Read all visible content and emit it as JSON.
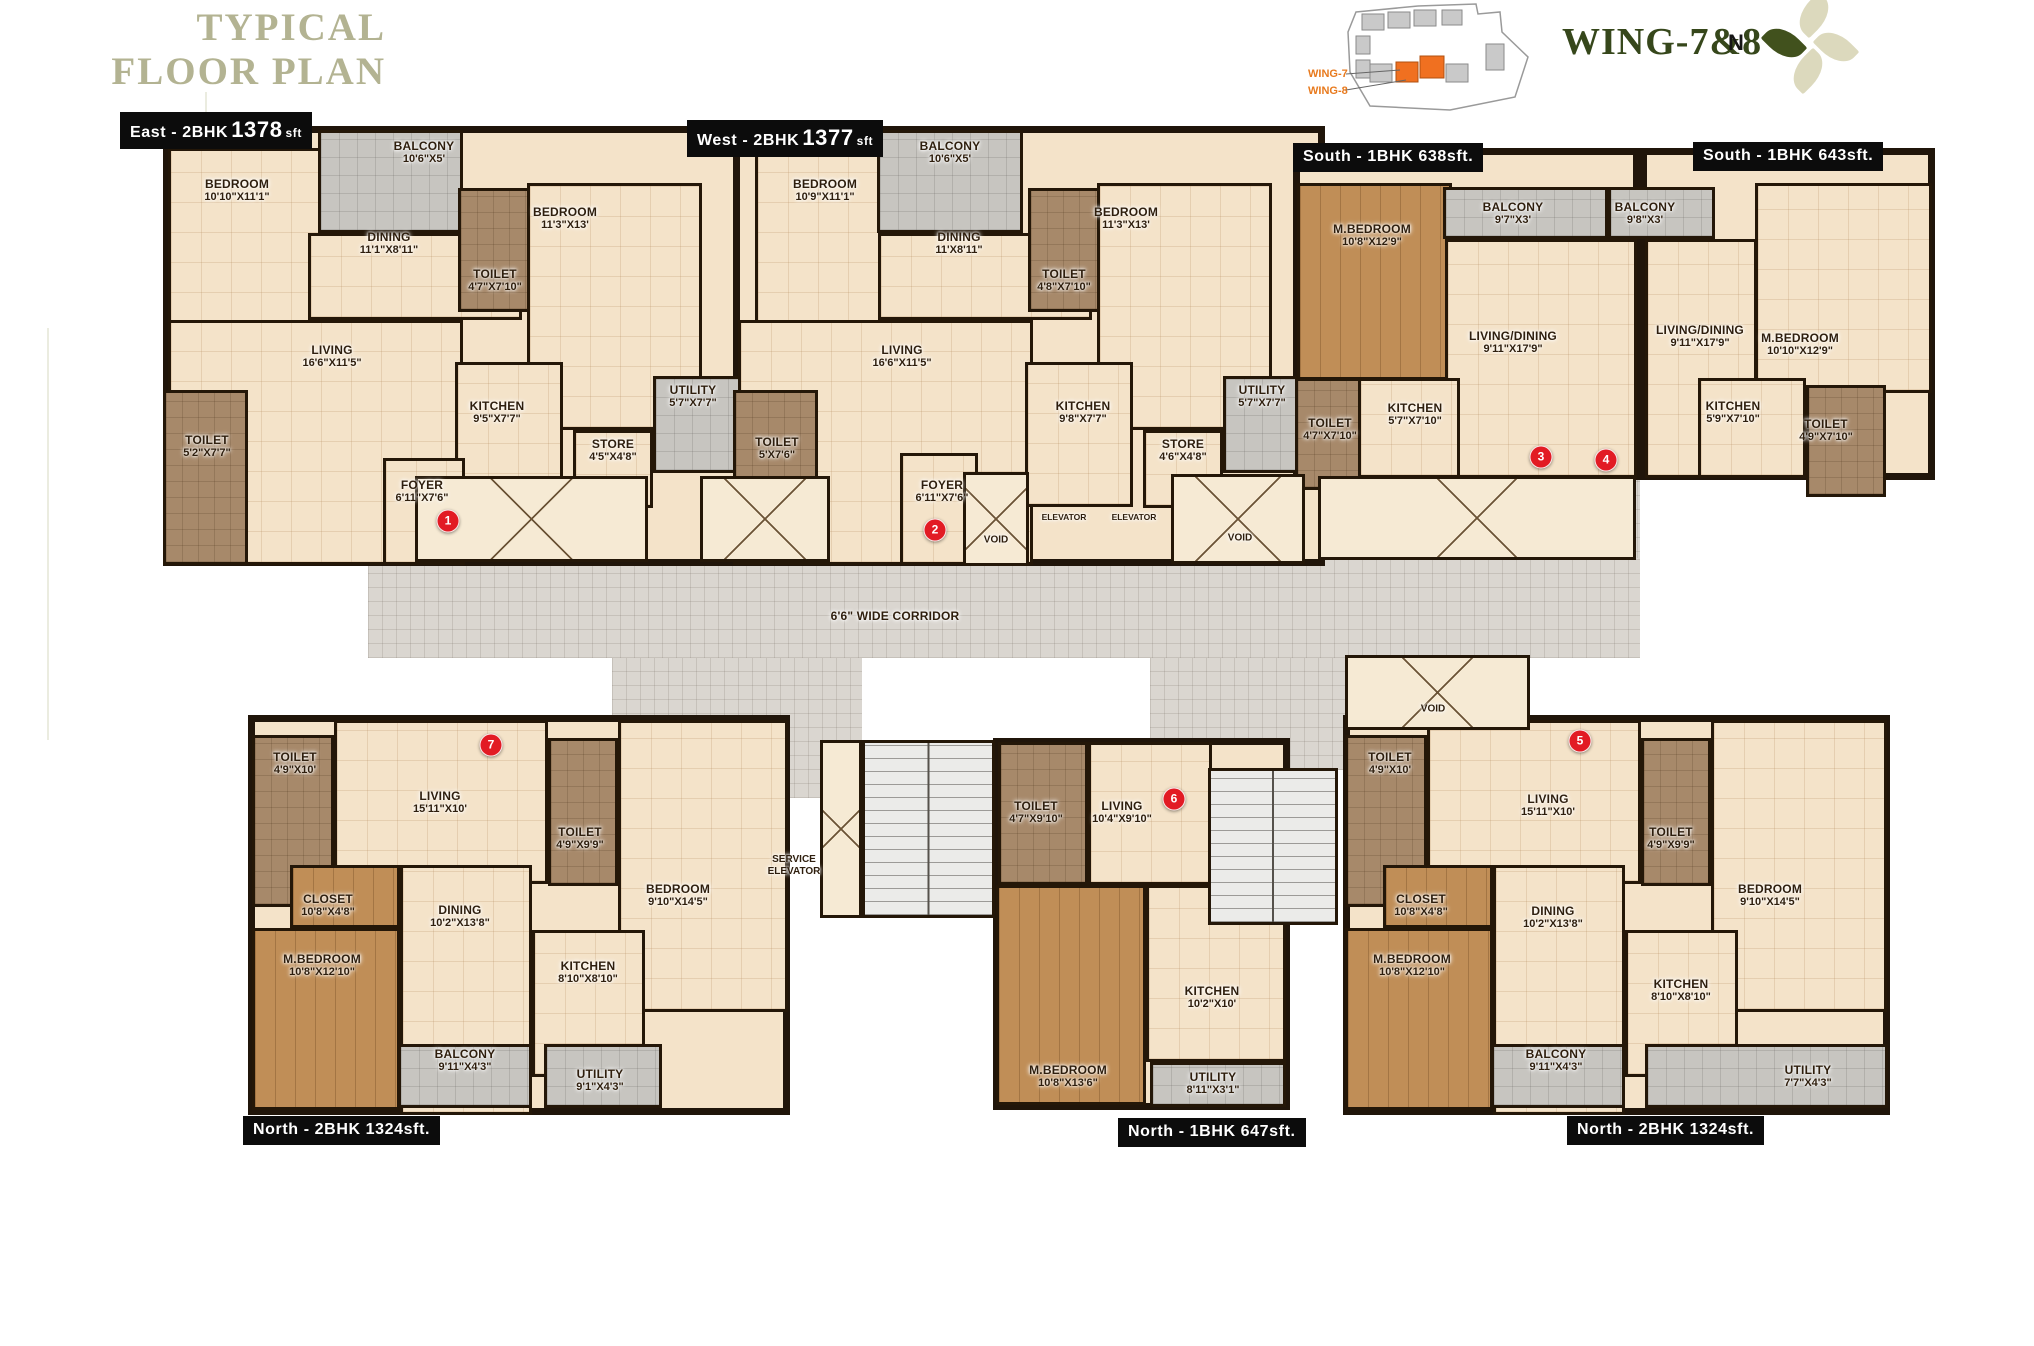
{
  "header": {
    "title_line1": "TYPICAL",
    "title_line2": "FLOOR PLAN",
    "wing_title": "WING-7&8",
    "north_label": "N",
    "keyplan": {
      "wing7": "WING-7",
      "wing8": "WING-8",
      "highlight_color": "#f07020",
      "building_color": "#c9c9c9"
    }
  },
  "colors": {
    "wall": "#241708",
    "cream": "#f4e3c9",
    "toilet": "#a7896a",
    "wood": "#c08e57",
    "gray": "#c7c5c0",
    "corridor": "#dad6d0",
    "badge_red": "#e21b24",
    "title_sage": "#b3b392",
    "wing_green": "#36471b",
    "accent_orange": "#e87a1e"
  },
  "plates": [
    {
      "id": "east",
      "x": 120,
      "y": 112,
      "pre": "East - 2BHK",
      "big": "1378",
      "suf": "sft"
    },
    {
      "id": "west",
      "x": 687,
      "y": 120,
      "pre": "West - 2BHK",
      "big": "1377",
      "suf": "sft"
    },
    {
      "id": "s638",
      "x": 1293,
      "y": 143,
      "pre": "South - 1BHK 638sft.",
      "big": "",
      "suf": ""
    },
    {
      "id": "s643",
      "x": 1693,
      "y": 142,
      "pre": "South - 1BHK 643sft.",
      "big": "",
      "suf": ""
    },
    {
      "id": "n1324a",
      "x": 243,
      "y": 1116,
      "pre": "North - 2BHK 1324sft.",
      "big": "",
      "suf": ""
    },
    {
      "id": "n647",
      "x": 1118,
      "y": 1118,
      "pre": "North - 1BHK 647sft.",
      "big": "",
      "suf": ""
    },
    {
      "id": "n1324b",
      "x": 1567,
      "y": 1116,
      "pre": "North - 2BHK 1324sft.",
      "big": "",
      "suf": ""
    }
  ],
  "corridor_areas": [
    {
      "id": "corridor-upper",
      "rect": [
        755,
        470,
        885,
        96
      ]
    },
    {
      "id": "corridor-main",
      "rect": [
        368,
        558,
        1272,
        100
      ],
      "label": "6'6\" WIDE CORRIDOR",
      "lx": 895,
      "ly": 616
    },
    {
      "id": "lobby-left",
      "rect": [
        612,
        658,
        250,
        140
      ]
    },
    {
      "id": "lobby-right",
      "rect": [
        1150,
        658,
        198,
        112
      ]
    }
  ],
  "units": [
    {
      "id": "east",
      "rect": [
        163,
        126,
        595,
        440
      ]
    },
    {
      "id": "west",
      "rect": [
        733,
        126,
        592,
        440
      ]
    },
    {
      "id": "s638",
      "rect": [
        1293,
        148,
        347,
        332
      ]
    },
    {
      "id": "s643",
      "rect": [
        1640,
        148,
        295,
        332
      ]
    },
    {
      "id": "n7",
      "rect": [
        248,
        715,
        542,
        400
      ]
    },
    {
      "id": "n6",
      "rect": [
        993,
        738,
        297,
        372
      ]
    },
    {
      "id": "n5",
      "rect": [
        1343,
        715,
        547,
        400
      ]
    }
  ],
  "rooms": [
    {
      "unit": "east",
      "name": "BEDROOM",
      "dims": "10'10\"X11'1\"",
      "type": "cream",
      "rect": [
        168,
        148,
        237,
        268
      ],
      "lx": 237,
      "ly": 190
    },
    {
      "unit": "east",
      "name": "BALCONY",
      "dims": "10'6\"X5'",
      "type": "gray",
      "rect": [
        318,
        130,
        145,
        103
      ],
      "lx": 424,
      "ly": 152
    },
    {
      "unit": "east",
      "name": "DINING",
      "dims": "11'1\"X8'11\"",
      "type": "cream",
      "rect": [
        308,
        233,
        214,
        87
      ],
      "lx": 389,
      "ly": 243
    },
    {
      "unit": "east",
      "name": "LIVING",
      "dims": "16'6\"X11'5\"",
      "type": "cream",
      "rect": [
        168,
        320,
        295,
        245
      ],
      "lx": 332,
      "ly": 356
    },
    {
      "unit": "east",
      "name": "TOILET",
      "dims": "4'7\"X7'10\"",
      "type": "toilet",
      "rect": [
        458,
        188,
        72,
        124
      ],
      "lx": 495,
      "ly": 280
    },
    {
      "unit": "east",
      "name": "BEDROOM",
      "dims": "11'3\"X13'",
      "type": "cream",
      "rect": [
        527,
        183,
        175,
        247
      ],
      "lx": 565,
      "ly": 218
    },
    {
      "unit": "east",
      "name": "TOILET",
      "dims": "5'2\"X7'7\"",
      "type": "toilet",
      "rect": [
        163,
        390,
        85,
        175
      ],
      "lx": 207,
      "ly": 446
    },
    {
      "unit": "east",
      "name": "KITCHEN",
      "dims": "9'5\"X7'7\"",
      "type": "cream",
      "rect": [
        455,
        362,
        108,
        145
      ],
      "lx": 497,
      "ly": 412
    },
    {
      "unit": "east",
      "name": "STORE",
      "dims": "4'5\"X4'8\"",
      "type": "cream",
      "rect": [
        573,
        430,
        80,
        78
      ],
      "lx": 613,
      "ly": 450
    },
    {
      "unit": "east",
      "name": "UTILITY",
      "dims": "5'7\"X7'7\"",
      "type": "gray",
      "rect": [
        653,
        376,
        102,
        97
      ],
      "lx": 693,
      "ly": 396
    },
    {
      "unit": "east",
      "name": "FOYER",
      "dims": "6'11\"X7'6\"",
      "type": "cream",
      "rect": [
        383,
        458,
        82,
        107
      ],
      "lx": 422,
      "ly": 491
    },
    {
      "unit": "west",
      "name": "BEDROOM",
      "dims": "10'9\"X11'1\"",
      "type": "cream",
      "rect": [
        755,
        148,
        237,
        268
      ],
      "lx": 825,
      "ly": 190
    },
    {
      "unit": "west",
      "name": "BALCONY",
      "dims": "10'6\"X5'",
      "type": "gray",
      "rect": [
        877,
        130,
        146,
        103
      ],
      "lx": 950,
      "ly": 152
    },
    {
      "unit": "west",
      "name": "DINING",
      "dims": "11'X8'11\"",
      "type": "cream",
      "rect": [
        878,
        233,
        214,
        87
      ],
      "lx": 959,
      "ly": 243
    },
    {
      "unit": "west",
      "name": "LIVING",
      "dims": "16'6\"X11'5\"",
      "type": "cream",
      "rect": [
        738,
        320,
        295,
        245
      ],
      "lx": 902,
      "ly": 356
    },
    {
      "unit": "west",
      "name": "TOILET",
      "dims": "4'8\"X7'10\"",
      "type": "toilet",
      "rect": [
        1028,
        188,
        72,
        124
      ],
      "lx": 1064,
      "ly": 280
    },
    {
      "unit": "west",
      "name": "BEDROOM",
      "dims": "11'3\"X13'",
      "type": "cream",
      "rect": [
        1097,
        183,
        175,
        247
      ],
      "lx": 1126,
      "ly": 218
    },
    {
      "unit": "west",
      "name": "TOILET",
      "dims": "5'X7'6\"",
      "type": "toilet",
      "rect": [
        733,
        390,
        85,
        175
      ],
      "lx": 777,
      "ly": 448
    },
    {
      "unit": "west",
      "name": "KITCHEN",
      "dims": "9'8\"X7'7\"",
      "type": "cream",
      "rect": [
        1025,
        362,
        108,
        145
      ],
      "lx": 1083,
      "ly": 412
    },
    {
      "unit": "west",
      "name": "STORE",
      "dims": "4'6\"X4'8\"",
      "type": "cream",
      "rect": [
        1143,
        430,
        80,
        78
      ],
      "lx": 1183,
      "ly": 450
    },
    {
      "unit": "west",
      "name": "UTILITY",
      "dims": "5'7\"X7'7\"",
      "type": "gray",
      "rect": [
        1223,
        376,
        100,
        97
      ],
      "lx": 1262,
      "ly": 396
    },
    {
      "unit": "west",
      "name": "FOYER",
      "dims": "6'11\"X7'6\"",
      "type": "cream",
      "rect": [
        900,
        453,
        78,
        112
      ],
      "lx": 942,
      "ly": 491
    },
    {
      "unit": "s638",
      "name": "M.BEDROOM",
      "dims": "10'8\"X12'9\"",
      "type": "wood",
      "rect": [
        1297,
        183,
        155,
        197
      ],
      "lx": 1372,
      "ly": 235
    },
    {
      "unit": "s638",
      "name": "BALCONY",
      "dims": "9'7\"X3'",
      "type": "gray",
      "rect": [
        1443,
        187,
        165,
        52
      ],
      "lx": 1513,
      "ly": 213
    },
    {
      "unit": "s638",
      "name": "LIVING/DINING",
      "dims": "9'11\"X17'9\"",
      "type": "cream",
      "rect": [
        1445,
        239,
        192,
        239
      ],
      "lx": 1513,
      "ly": 342
    },
    {
      "unit": "s638",
      "name": "KITCHEN",
      "dims": "5'7\"X7'10\"",
      "type": "cream",
      "rect": [
        1358,
        378,
        102,
        100
      ],
      "lx": 1415,
      "ly": 414
    },
    {
      "unit": "s638",
      "name": "TOILET",
      "dims": "4'7\"X7'10\"",
      "type": "toilet",
      "rect": [
        1295,
        378,
        66,
        112
      ],
      "lx": 1330,
      "ly": 429
    },
    {
      "unit": "s643",
      "name": "BALCONY",
      "dims": "9'8\"X3'",
      "type": "gray",
      "rect": [
        1608,
        187,
        107,
        52
      ],
      "lx": 1645,
      "ly": 213
    },
    {
      "unit": "s643",
      "name": "LIVING/DINING",
      "dims": "9'11\"X17'9\"",
      "type": "cream",
      "rect": [
        1645,
        239,
        112,
        239
      ],
      "lx": 1700,
      "ly": 336
    },
    {
      "unit": "s643",
      "name": "M.BEDROOM",
      "dims": "10'10\"X12'9\"",
      "type": "cream",
      "rect": [
        1755,
        183,
        177,
        210
      ],
      "lx": 1800,
      "ly": 344
    },
    {
      "unit": "s643",
      "name": "KITCHEN",
      "dims": "5'9\"X7'10\"",
      "type": "cream",
      "rect": [
        1698,
        378,
        108,
        100
      ],
      "lx": 1733,
      "ly": 412
    },
    {
      "unit": "s643",
      "name": "TOILET",
      "dims": "4'9\"X7'10\"",
      "type": "toilet",
      "rect": [
        1806,
        385,
        80,
        112
      ],
      "lx": 1826,
      "ly": 430
    },
    {
      "unit": "n7",
      "name": "TOILET",
      "dims": "4'9\"X10'",
      "type": "toilet",
      "rect": [
        252,
        735,
        82,
        172
      ],
      "lx": 295,
      "ly": 763
    },
    {
      "unit": "n7",
      "name": "LIVING",
      "dims": "15'11\"X10'",
      "type": "cream",
      "rect": [
        334,
        720,
        214,
        164
      ],
      "lx": 440,
      "ly": 802
    },
    {
      "unit": "n7",
      "name": "TOILET",
      "dims": "4'9\"X9'9\"",
      "type": "toilet",
      "rect": [
        548,
        738,
        70,
        148
      ],
      "lx": 580,
      "ly": 838
    },
    {
      "unit": "n7",
      "name": "BEDROOM",
      "dims": "9'10\"X14'5\"",
      "type": "cream",
      "rect": [
        618,
        720,
        170,
        292
      ],
      "lx": 678,
      "ly": 895
    },
    {
      "unit": "n7",
      "name": "CLOSET",
      "dims": "10'8\"X4'8\"",
      "type": "wood",
      "rect": [
        290,
        865,
        110,
        63
      ],
      "lx": 328,
      "ly": 905
    },
    {
      "unit": "n7",
      "name": "M.BEDROOM",
      "dims": "10'8\"X12'10\"",
      "type": "wood",
      "rect": [
        252,
        928,
        148,
        182
      ],
      "lx": 322,
      "ly": 965
    },
    {
      "unit": "n7",
      "name": "DINING",
      "dims": "10'2\"X13'8\"",
      "type": "cream",
      "rect": [
        400,
        865,
        132,
        250
      ],
      "lx": 460,
      "ly": 916
    },
    {
      "unit": "n7",
      "name": "KITCHEN",
      "dims": "8'10\"X8'10\"",
      "type": "cream",
      "rect": [
        532,
        930,
        113,
        147
      ],
      "lx": 588,
      "ly": 972
    },
    {
      "unit": "n7",
      "name": "BALCONY",
      "dims": "9'11\"X4'3\"",
      "type": "gray",
      "rect": [
        398,
        1044,
        134,
        64
      ],
      "lx": 465,
      "ly": 1060
    },
    {
      "unit": "n7",
      "name": "UTILITY",
      "dims": "9'1\"X4'3\"",
      "type": "gray",
      "rect": [
        544,
        1044,
        118,
        64
      ],
      "lx": 600,
      "ly": 1080
    },
    {
      "unit": "n6",
      "name": "TOILET",
      "dims": "4'7\"X9'10\"",
      "type": "toilet",
      "rect": [
        998,
        742,
        90,
        143
      ],
      "lx": 1036,
      "ly": 812
    },
    {
      "unit": "n6",
      "name": "LIVING",
      "dims": "10'4\"X9'10\"",
      "type": "cream",
      "rect": [
        1088,
        742,
        124,
        143
      ],
      "lx": 1122,
      "ly": 812
    },
    {
      "unit": "n6",
      "name": "M.BEDROOM",
      "dims": "10'8\"X13'6\"",
      "type": "wood",
      "rect": [
        996,
        885,
        150,
        220
      ],
      "lx": 1068,
      "ly": 1076
    },
    {
      "unit": "n6",
      "name": "KITCHEN",
      "dims": "10'2\"X10'",
      "type": "cream",
      "rect": [
        1146,
        885,
        140,
        177
      ],
      "lx": 1212,
      "ly": 997
    },
    {
      "unit": "n6",
      "name": "UTILITY",
      "dims": "8'11\"X3'1\"",
      "type": "gray",
      "rect": [
        1150,
        1062,
        136,
        45
      ],
      "lx": 1213,
      "ly": 1083
    },
    {
      "unit": "n5",
      "name": "TOILET",
      "dims": "4'9\"X10'",
      "type": "toilet",
      "rect": [
        1345,
        735,
        82,
        172
      ],
      "lx": 1390,
      "ly": 763
    },
    {
      "unit": "n5",
      "name": "LIVING",
      "dims": "15'11\"X10'",
      "type": "cream",
      "rect": [
        1427,
        720,
        214,
        164
      ],
      "lx": 1548,
      "ly": 805
    },
    {
      "unit": "n5",
      "name": "TOILET",
      "dims": "4'9\"X9'9\"",
      "type": "toilet",
      "rect": [
        1641,
        738,
        70,
        148
      ],
      "lx": 1671,
      "ly": 838
    },
    {
      "unit": "n5",
      "name": "BEDROOM",
      "dims": "9'10\"X14'5\"",
      "type": "cream",
      "rect": [
        1711,
        720,
        176,
        292
      ],
      "lx": 1770,
      "ly": 895
    },
    {
      "unit": "n5",
      "name": "CLOSET",
      "dims": "10'8\"X4'8\"",
      "type": "wood",
      "rect": [
        1383,
        865,
        110,
        63
      ],
      "lx": 1421,
      "ly": 905
    },
    {
      "unit": "n5",
      "name": "M.BEDROOM",
      "dims": "10'8\"X12'10\"",
      "type": "wood",
      "rect": [
        1345,
        928,
        148,
        182
      ],
      "lx": 1412,
      "ly": 965
    },
    {
      "unit": "n5",
      "name": "DINING",
      "dims": "10'2\"X13'8\"",
      "type": "cream",
      "rect": [
        1493,
        865,
        132,
        250
      ],
      "lx": 1553,
      "ly": 917
    },
    {
      "unit": "n5",
      "name": "KITCHEN",
      "dims": "8'10\"X8'10\"",
      "type": "cream",
      "rect": [
        1625,
        930,
        113,
        147
      ],
      "lx": 1681,
      "ly": 990
    },
    {
      "unit": "n5",
      "name": "BALCONY",
      "dims": "9'11\"X4'3\"",
      "type": "gray",
      "rect": [
        1491,
        1044,
        134,
        64
      ],
      "lx": 1556,
      "ly": 1060
    },
    {
      "unit": "n5",
      "name": "UTILITY",
      "dims": "7'7\"X4'3\"",
      "type": "gray",
      "rect": [
        1645,
        1044,
        243,
        64
      ],
      "lx": 1808,
      "ly": 1076
    }
  ],
  "cores": [
    {
      "id": "open-box-1",
      "type": "void",
      "rect": [
        415,
        476,
        233,
        86
      ]
    },
    {
      "id": "open-box-2",
      "type": "void",
      "rect": [
        700,
        476,
        130,
        86
      ]
    },
    {
      "id": "void-left",
      "type": "void",
      "label": "VOID",
      "rect": [
        963,
        472,
        66,
        94
      ],
      "lx": 996,
      "ly": 540
    },
    {
      "id": "elevator-1",
      "type": "elevator",
      "label": "ELEVATOR",
      "rect": [
        1033,
        474,
        62,
        93
      ],
      "lx": 1064,
      "ly": 517
    },
    {
      "id": "elevator-2",
      "type": "elevator",
      "label": "ELEVATOR",
      "rect": [
        1103,
        474,
        62,
        93
      ],
      "lx": 1134,
      "ly": 517
    },
    {
      "id": "void-right",
      "type": "void",
      "label": "VOID",
      "rect": [
        1171,
        474,
        134,
        90
      ],
      "lx": 1240,
      "ly": 538
    },
    {
      "id": "open-box-3",
      "type": "void",
      "rect": [
        1318,
        476,
        318,
        84
      ]
    },
    {
      "id": "shaft",
      "type": "void",
      "rect": [
        820,
        740,
        42,
        178
      ]
    },
    {
      "id": "stairs-left",
      "type": "stairs",
      "rect": [
        862,
        740,
        133,
        178
      ]
    },
    {
      "id": "service-elevator",
      "type": "elevator",
      "label": "SERVICE ELEVATOR",
      "rect": [
        732,
        798,
        125,
        135
      ],
      "lx": 794,
      "ly": 866
    },
    {
      "id": "stairs-right",
      "type": "stairs",
      "rect": [
        1208,
        768,
        130,
        157
      ]
    },
    {
      "id": "void-bottom",
      "type": "void",
      "label": "VOID",
      "rect": [
        1345,
        655,
        185,
        75
      ],
      "lx": 1433,
      "ly": 709
    }
  ],
  "badges": [
    {
      "n": "1",
      "x": 448,
      "y": 521
    },
    {
      "n": "2",
      "x": 935,
      "y": 530
    },
    {
      "n": "3",
      "x": 1541,
      "y": 457
    },
    {
      "n": "4",
      "x": 1606,
      "y": 460
    },
    {
      "n": "5",
      "x": 1580,
      "y": 741
    },
    {
      "n": "6",
      "x": 1174,
      "y": 799
    },
    {
      "n": "7",
      "x": 491,
      "y": 745
    }
  ]
}
